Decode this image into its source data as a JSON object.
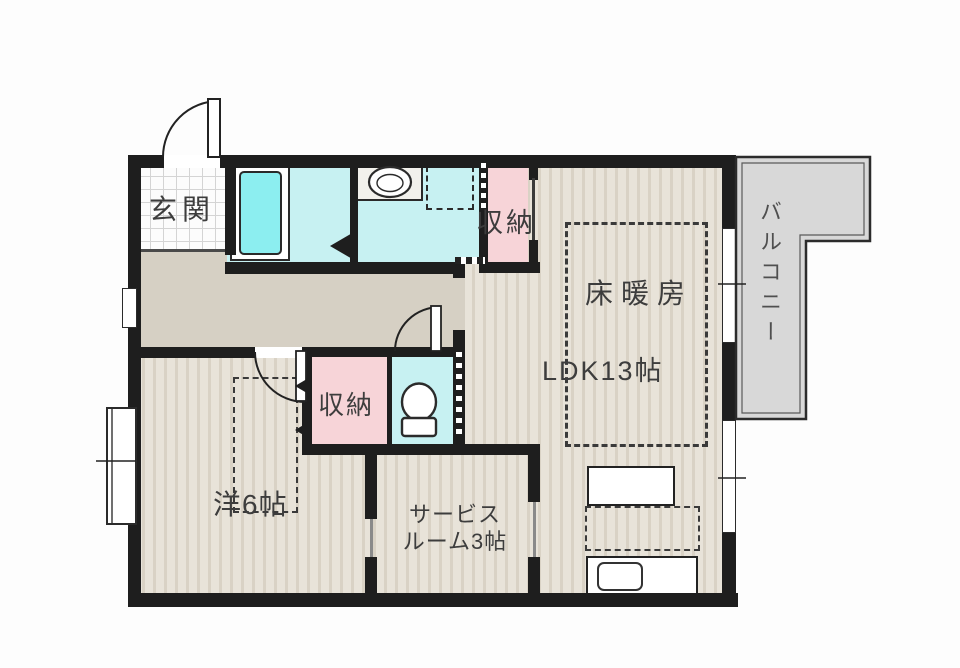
{
  "plan": {
    "type": "floor-plan",
    "rooms": {
      "entrance": "玄関",
      "upper_storage": "収納",
      "floor_heating": "床暖房",
      "ldk": "LDK13帖",
      "balcony": "バルコニー",
      "bedroom_storage": "収納",
      "bedroom": "洋6帖",
      "service_room_line1": "サービス",
      "service_room_line2": "ルーム3帖"
    },
    "colors": {
      "wall": "#1e1e1e",
      "wood_floor": "#e8e3d9",
      "wood_stripe": "#d9d2c5",
      "hallway_floor": "#d6d0c4",
      "wet_area": "#c7f1f2",
      "bathtub": "#8ceef0",
      "storage_pink": "#f7d4d8",
      "balcony_gray": "#d8d8d8",
      "label_text": "#3d3d3d"
    }
  }
}
